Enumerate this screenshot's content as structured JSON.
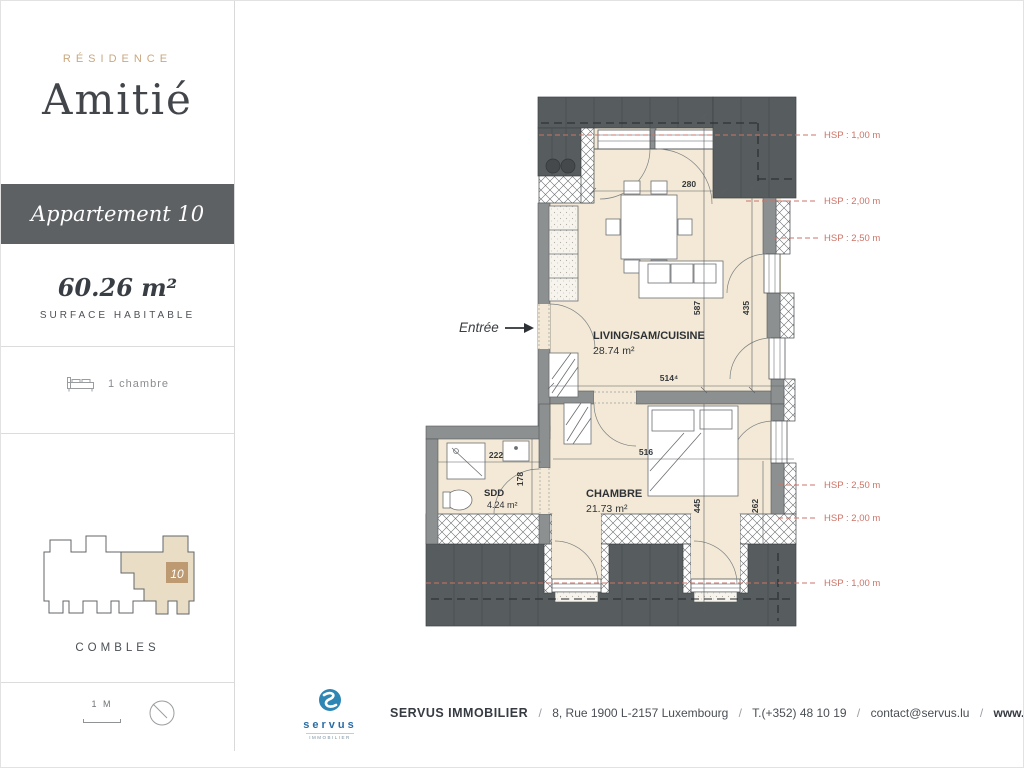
{
  "sidebar": {
    "residence_label": "RÉSIDENCE",
    "residence_name": "Amitié",
    "apartment_title": "Appartement 10",
    "surface_value": "60.26 m²",
    "surface_label": "SURFACE HABITABLE",
    "bedrooms_label": "1 chambre",
    "keyplan_unit": "10",
    "level_label": "COMBLES",
    "scale_label": "1 M"
  },
  "plan": {
    "entrance_label": "Entrée",
    "rooms": [
      {
        "name": "LIVING/SAM/CUISINE",
        "area": "28.74 m²"
      },
      {
        "name": "CHAMBRE",
        "area": "21.73 m²"
      },
      {
        "name": "SDD",
        "area": "4.24 m²"
      }
    ],
    "dimensions": [
      "280",
      "587",
      "435",
      "514⁴",
      "516",
      "222",
      "178",
      "445",
      "262"
    ],
    "hsp_labels": [
      "HSP : 1,00 m",
      "HSP : 2,00 m",
      "HSP : 2,50 m",
      "HSP : 2,50 m",
      "HSP : 2,00 m",
      "HSP : 1,00 m"
    ],
    "colors": {
      "floor": "#f3e9d6",
      "roof": "#575c5e",
      "wall": "#8d9091",
      "hsp_red": "#cd7468",
      "gold": "#c9a87f"
    }
  },
  "footer": {
    "brand_name": "servus",
    "brand_sub": "IMMOBILIER",
    "company": "SERVUS IMMOBILIER",
    "address": "8, Rue 1900 L-2157 Luxembourg",
    "phone": "T.(+352) 48 10 19",
    "email": "contact@servus.lu",
    "website": "www.servus.lu",
    "separator": "/"
  }
}
